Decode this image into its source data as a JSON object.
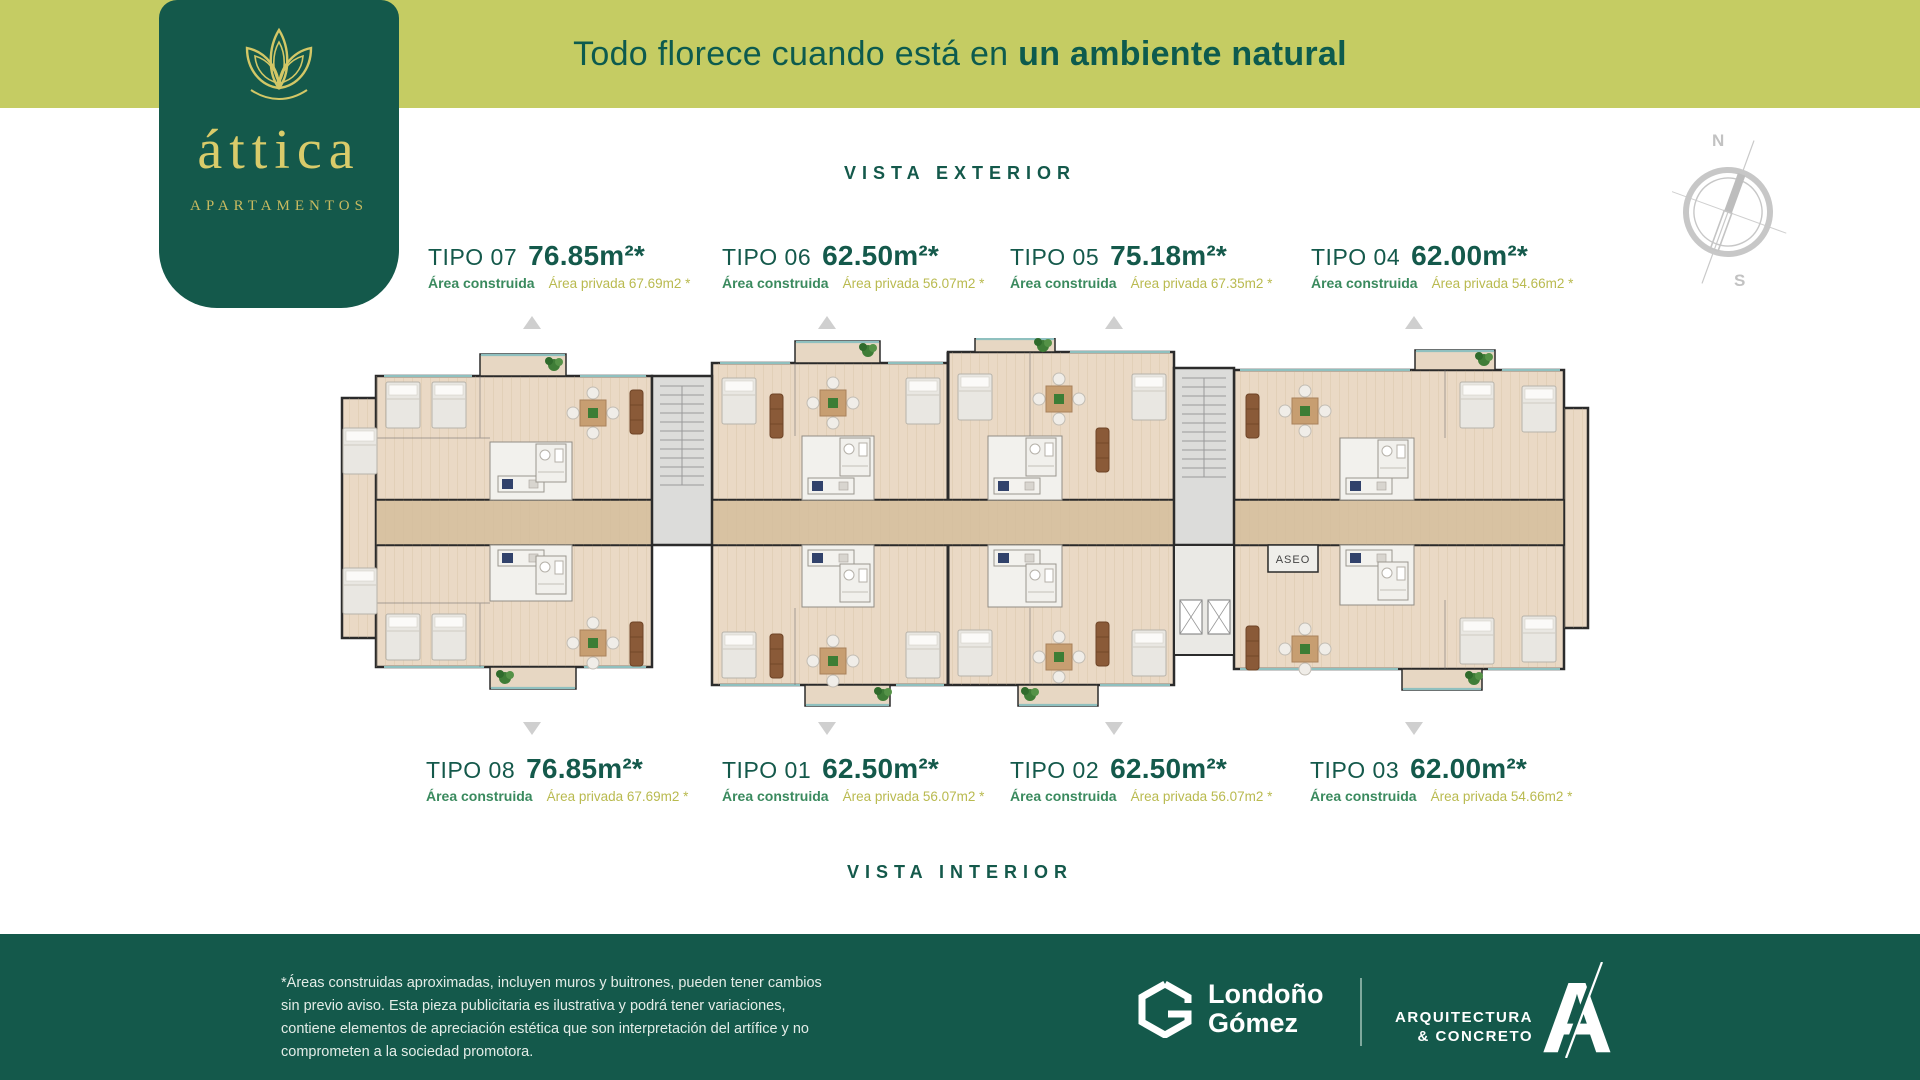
{
  "banner": {
    "text_regular": "Todo florece cuando está en ",
    "text_bold": "un ambiente natural"
  },
  "logo": {
    "name": "áttica",
    "subtitle": "APARTAMENTOS"
  },
  "headings": {
    "exterior": "VISTA EXTERIOR",
    "interior": "VISTA INTERIOR"
  },
  "compass": {
    "north": "N",
    "south": "S"
  },
  "labels": {
    "construida": "Área construida"
  },
  "types_top": [
    {
      "tipo": "TIPO 07",
      "area": "76.85m²*",
      "privada": "Área privada 67.69m2 *"
    },
    {
      "tipo": "TIPO 06",
      "area": "62.50m²*",
      "privada": "Área privada 56.07m2 *"
    },
    {
      "tipo": "TIPO 05",
      "area": "75.18m²*",
      "privada": "Área privada 67.35m2 *"
    },
    {
      "tipo": "TIPO 04",
      "area": "62.00m²*",
      "privada": "Área privada 54.66m2 *"
    }
  ],
  "types_bottom": [
    {
      "tipo": "TIPO 08",
      "area": "76.85m²*",
      "privada": "Área privada 67.69m2 *"
    },
    {
      "tipo": "TIPO 01",
      "area": "62.50m²*",
      "privada": "Área privada 56.07m2 *"
    },
    {
      "tipo": "TIPO 02",
      "area": "62.50m²*",
      "privada": "Área privada 56.07m2 *"
    },
    {
      "tipo": "TIPO 03",
      "area": "62.00m²*",
      "privada": "Área privada 54.66m2 *"
    }
  ],
  "floorplan": {
    "aseo_label": "ASEO"
  },
  "footer": {
    "disclaimer": "*Áreas construidas aproximadas, incluyen muros y buitrones, pueden tener cambios sin previo aviso. Esta pieza publicitaria es ilustrativa y podrá tener variaciones, contiene elementos de apreciación estética que son interpretación del artífice y no comprometen a la sociedad promotora.",
    "londono_line1": "Londoño",
    "londono_line2": "Gómez",
    "arq_line1": "ARQUITECTURA",
    "arq_line2": "& CONCRETO",
    "arq_mark": "A"
  },
  "colors": {
    "banner_bg": "#c5cc63",
    "brand_green": "#14594b",
    "heading_teal": "#0d5b4e",
    "logo_gold": "#d9cb6a",
    "construida_green": "#3a8a5e",
    "privada_olive": "#b9ba4f",
    "plan_floor": "#ead9c5",
    "plan_corridor": "#d8c2a2"
  }
}
